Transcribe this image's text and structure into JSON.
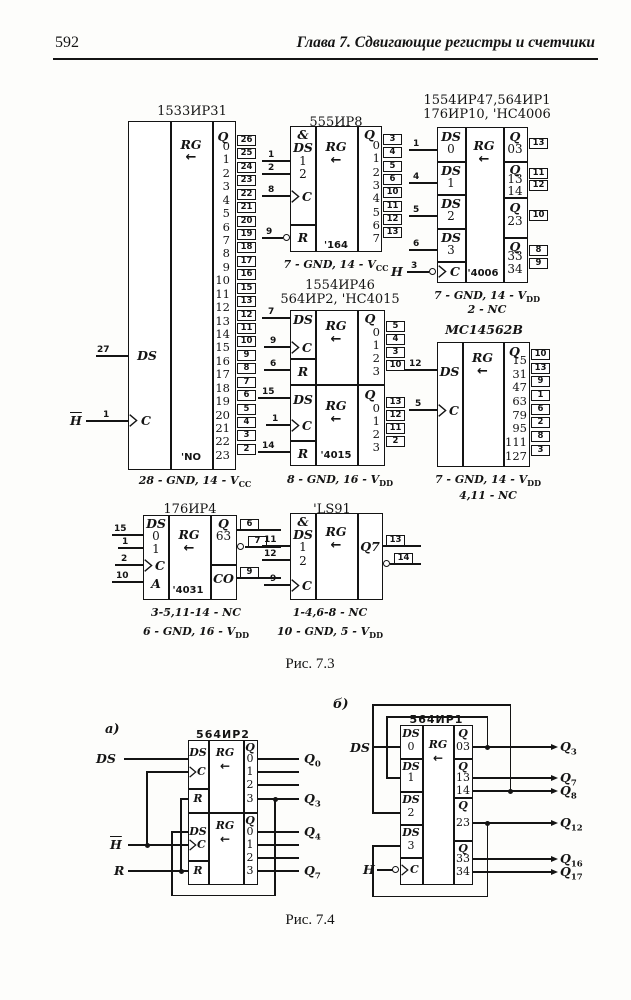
{
  "page": {
    "number": "592",
    "chapter": "Глава 7.  Сдвигающие регистры и счетчики"
  },
  "f73": {
    "caption": "Рис. 7.3",
    "ir31": {
      "title": "1533ИР31",
      "ds": "DS",
      "ds_pin": "27",
      "h": "H",
      "c_pin": "1",
      "c": "C",
      "rg": "RG",
      "arr": "←",
      "qh": "Q",
      "analog": "'NO",
      "gnd": "28 - GND, 14 - V",
      "gnd_sub": "CC",
      "outs": [
        {
          "q": "0",
          "pin": "26"
        },
        {
          "q": "1",
          "pin": "25"
        },
        {
          "q": "2",
          "pin": "24"
        },
        {
          "q": "3",
          "pin": "23"
        },
        {
          "q": "4",
          "pin": "22"
        },
        {
          "q": "5",
          "pin": "21"
        },
        {
          "q": "6",
          "pin": "20"
        },
        {
          "q": "7",
          "pin": "19"
        },
        {
          "q": "8",
          "pin": "18"
        },
        {
          "q": "9",
          "pin": "17"
        },
        {
          "q": "10",
          "pin": "16"
        },
        {
          "q": "11",
          "pin": "15"
        },
        {
          "q": "12",
          "pin": "13"
        },
        {
          "q": "13",
          "pin": "12"
        },
        {
          "q": "14",
          "pin": "11"
        },
        {
          "q": "15",
          "pin": "10"
        },
        {
          "q": "16",
          "pin": "9"
        },
        {
          "q": "17",
          "pin": "8"
        },
        {
          "q": "18",
          "pin": "7"
        },
        {
          "q": "19",
          "pin": "6"
        },
        {
          "q": "20",
          "pin": "5"
        },
        {
          "q": "21",
          "pin": "4"
        },
        {
          "q": "22",
          "pin": "3"
        },
        {
          "q": "23",
          "pin": "2"
        }
      ]
    },
    "ir8": {
      "title": "555ИР8",
      "amp": "&",
      "ds": "DS",
      "in1": "1",
      "in2": "2",
      "p1": "1",
      "p2": "2",
      "c": "C",
      "c_pin": "8",
      "r": "R",
      "r_pin": "9",
      "rg": "RG",
      "arr": "←",
      "qh": "Q",
      "analog": "'164",
      "gnd": "7 - GND, 14 - V",
      "gnd_sub": "CC",
      "outs": [
        {
          "q": "0",
          "pin": "3"
        },
        {
          "q": "1",
          "pin": "4"
        },
        {
          "q": "2",
          "pin": "5"
        },
        {
          "q": "3",
          "pin": "6"
        },
        {
          "q": "4",
          "pin": "10"
        },
        {
          "q": "5",
          "pin": "11"
        },
        {
          "q": "6",
          "pin": "12"
        },
        {
          "q": "7",
          "pin": "13"
        }
      ]
    },
    "ir1": {
      "t1": "1554ИР47,564ИР1",
      "t2": "176ИР10, 'HC4006",
      "h": "H",
      "c": "C",
      "c_pin": "3",
      "rg": "RG",
      "arr": "←",
      "qh": "Q",
      "analog": "'4006",
      "gnd": "7 - GND, 14 - V",
      "gnd_sub": "DD",
      "note": "2 - NC",
      "db": [
        {
          "h": "DS",
          "n": "0",
          "pin": "1"
        },
        {
          "h": "DS",
          "n": "1",
          "pin": "4"
        },
        {
          "h": "DS",
          "n": "2",
          "pin": "5"
        },
        {
          "h": "DS",
          "n": "3",
          "pin": "6"
        }
      ],
      "qb": [
        {
          "rows": [
            {
              "t": "03",
              "pin": "13"
            }
          ]
        },
        {
          "rows": [
            {
              "t": "13",
              "pin": "11"
            },
            {
              "t": "14",
              "pin": "12"
            }
          ]
        },
        {
          "rows": [
            {
              "t": "23",
              "pin": "10"
            }
          ]
        },
        {
          "rows": [
            {
              "t": "33",
              "pin": "8"
            },
            {
              "t": "34",
              "pin": "9"
            }
          ]
        }
      ]
    },
    "ir2": {
      "t1": "1554ИР46",
      "t2": "564ИР2, 'HC4015",
      "ds": "DS",
      "c": "C",
      "r": "R",
      "rg": "RG",
      "arr": "←",
      "qh": "Q",
      "analog": "'4015",
      "gnd": "8 - GND, 16 - V",
      "gnd_sub": "DD",
      "top": {
        "ds_pin": "7",
        "c_pin": "9",
        "r_pin": "6",
        "outs": [
          {
            "q": "0",
            "pin": "5"
          },
          {
            "q": "1",
            "pin": "4"
          },
          {
            "q": "2",
            "pin": "3"
          },
          {
            "q": "3",
            "pin": "10"
          }
        ]
      },
      "bot": {
        "ds_pin": "15",
        "c_pin": "1",
        "r_pin": "14",
        "outs": [
          {
            "q": "0",
            "pin": "13"
          },
          {
            "q": "1",
            "pin": "12"
          },
          {
            "q": "2",
            "pin": "11"
          },
          {
            "q": "3",
            "pin": "2"
          }
        ]
      }
    },
    "mc": {
      "title": "MC14562B",
      "ds": "DS",
      "ds_pin": "12",
      "c": "C",
      "c_pin": "5",
      "rg": "RG",
      "arr": "←",
      "qh": "Q",
      "gnd": "7 - GND, 14 - V",
      "gnd_sub": "DD",
      "note": "4,11 - NC",
      "outs": [
        {
          "q": "15",
          "pin": "10"
        },
        {
          "q": "31",
          "pin": "13"
        },
        {
          "q": "47",
          "pin": "9"
        },
        {
          "q": "63",
          "pin": "1"
        },
        {
          "q": "79",
          "pin": "6"
        },
        {
          "q": "95",
          "pin": "2"
        },
        {
          "q": "111",
          "pin": "8"
        },
        {
          "q": "127",
          "pin": "3"
        }
      ]
    },
    "ir4": {
      "title": "176ИР4",
      "ds": "DS",
      "r0": "0",
      "r0_pin": "15",
      "r1": "1",
      "r1_pin": "1",
      "c": "C",
      "c_pin": "2",
      "a": "A",
      "a_pin": "10",
      "rg": "RG",
      "arr": "←",
      "qh": "Q",
      "qv": "63",
      "q_pin": "6",
      "qn_pin": "7",
      "co": "CO",
      "co_pin": "9",
      "analog": "'4031",
      "note": "3-5,11-14 - NC",
      "gnd": "6 - GND, 16 - V",
      "gnd_sub": "DD"
    },
    "ls91": {
      "title": "'LS91",
      "amp": "&",
      "ds": "DS",
      "in1": "1",
      "in1_pin": "11",
      "in2": "2",
      "in2_pin": "12",
      "c": "C",
      "c_pin": "9",
      "rg": "RG",
      "arr": "←",
      "q7": "Q7",
      "p13": "13",
      "p14": "14",
      "note": "1-4,6-8 - NC",
      "gnd": "10 - GND, 5 - V",
      "gnd_sub": "DD"
    }
  },
  "f74": {
    "caption": "Рис. 7.4",
    "a": {
      "tag": "а)",
      "title": "564ИР2",
      "ds": "DS",
      "h": "H",
      "r": "R",
      "c": "C",
      "rg": "RG",
      "arr": "←",
      "qh": "Q",
      "rows": [
        "0",
        "1",
        "2",
        "3"
      ],
      "q0": {
        "b": "Q",
        "s": "0"
      },
      "q3": {
        "b": "Q",
        "s": "3"
      },
      "q4": {
        "b": "Q",
        "s": "4"
      },
      "q7": {
        "b": "Q",
        "s": "7"
      }
    },
    "b": {
      "tag": "б)",
      "title": "564ИР1",
      "ds": "DS",
      "h": "H",
      "c": "C",
      "rg": "RG",
      "arr": "←",
      "qh": "Q",
      "db": [
        {
          "h": "DS",
          "n": "0"
        },
        {
          "h": "DS",
          "n": "1"
        },
        {
          "h": "DS",
          "n": "2"
        },
        {
          "h": "DS",
          "n": "3"
        }
      ],
      "qr": [
        "03",
        "13",
        "14",
        "23",
        "33",
        "34"
      ],
      "q3": {
        "b": "Q",
        "s": "3"
      },
      "q7": {
        "b": "Q",
        "s": "7"
      },
      "q8": {
        "b": "Q",
        "s": "8"
      },
      "q12": {
        "b": "Q",
        "s": "12"
      },
      "q16": {
        "b": "Q",
        "s": "16"
      },
      "q17": {
        "b": "Q",
        "s": "17"
      }
    }
  }
}
